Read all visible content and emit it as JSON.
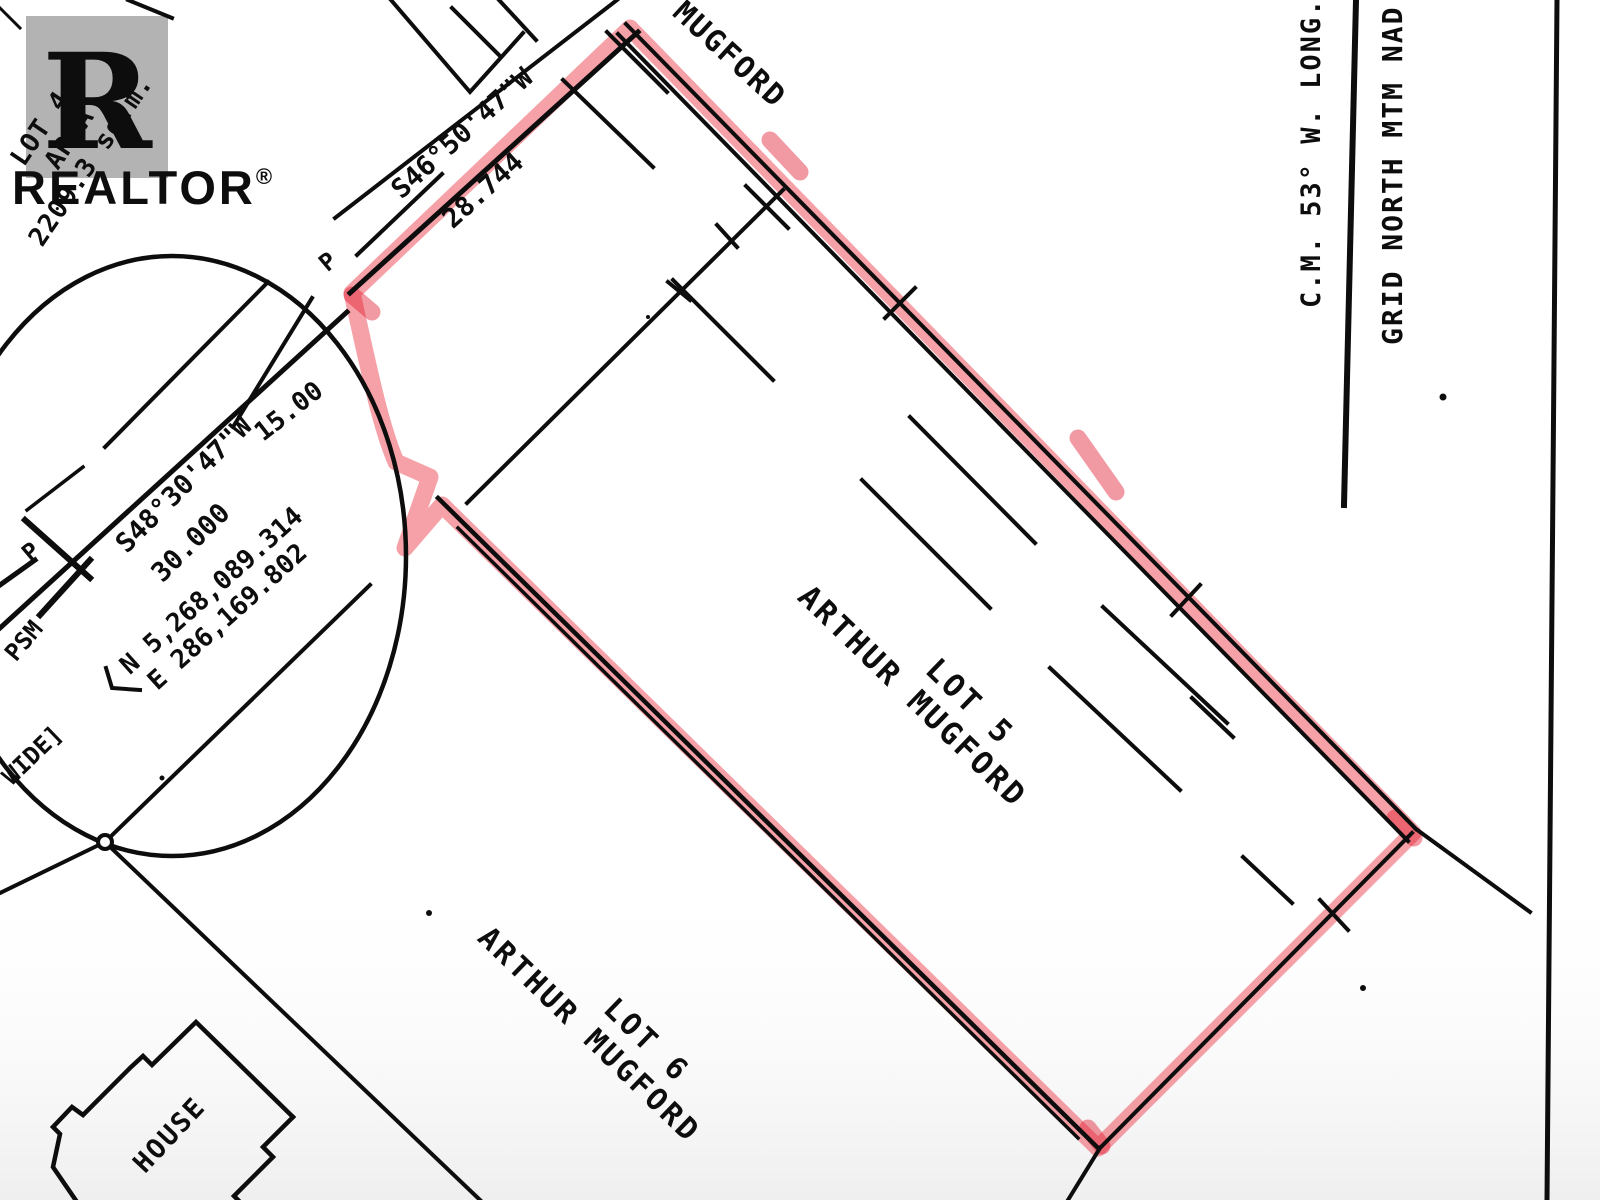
{
  "watermark": {
    "logo_letter": "R",
    "brand": "REALTOR",
    "registered_mark": "®"
  },
  "parcels": {
    "lot4": {
      "line1": "LOT 4",
      "line2": "AREA",
      "line3": "2209.3 sq.m."
    },
    "lot5": {
      "name": "LOT 5",
      "owner": "ARTHUR MUGFORD"
    },
    "lot6": {
      "name": "LOT 6",
      "owner": "ARTHUR MUGFORD"
    },
    "adjacent_owner_top": "MUGFORD",
    "house_label": "HOUSE"
  },
  "bearings": {
    "street_top": {
      "bearing": "S46°50'47\"W",
      "distance": "28.744"
    },
    "street_curve": {
      "bearing": "S48°30'47\"W",
      "distance_a": "30.000",
      "distance_b": "15.00"
    }
  },
  "coordinates": {
    "northing": "N 5,268,089.314",
    "easting": "E 286,169.802"
  },
  "monuments": {
    "p_top": "P",
    "p_left": "P",
    "psm": "PSM"
  },
  "road_note": "WIDE]",
  "north_arrow": {
    "longitude_label": "C.M. 53° W. LONG.",
    "grid_label": "GRID NORTH MTM NAD"
  },
  "colors": {
    "highlight": "#ee4150",
    "highlight_dark": "#e11f33",
    "ink": "#0d0d0d",
    "watermark": "#b3b3b3"
  }
}
